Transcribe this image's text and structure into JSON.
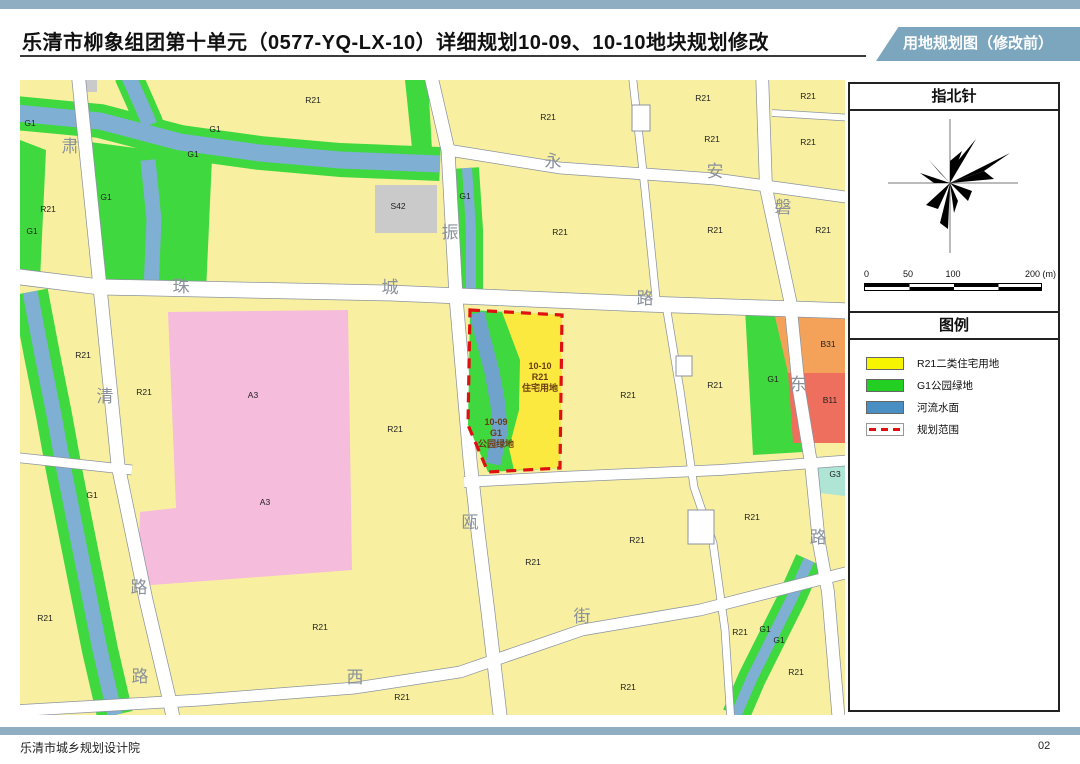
{
  "header": {
    "title": "乐清市柳象组团第十单元（0577-YQ-LX-10）详细规划10-09、10-10地块规划修改",
    "tag": "用地规划图（修改前）"
  },
  "footer": {
    "org": "乐清市城乡规划设计院",
    "page": "02"
  },
  "sidebar": {
    "compass_title": "指北针",
    "legend_title": "图例",
    "scale_ticks": [
      "0",
      "50",
      "100",
      "200 (m)"
    ],
    "legend_items": [
      {
        "label": "R21二类住宅用地",
        "swatch": "fill",
        "color": "#F7F400"
      },
      {
        "label": "G1公园绿地",
        "swatch": "fill",
        "color": "#22CF22"
      },
      {
        "label": "河流水面",
        "swatch": "fill",
        "color": "#4A8FC4"
      },
      {
        "label": "规划范围",
        "swatch": "dashed",
        "color": "#E01010"
      }
    ]
  },
  "map": {
    "colors": {
      "residential_yellow": "#F8F0A0",
      "park_green": "#3FD83F",
      "river_blue": "#7FAFD3",
      "plot_highlight_yellow": "#FBE93F",
      "a3_pink": "#F5BCDC",
      "s42_gray": "#CACACA",
      "b31_orange": "#F4A259",
      "b11_red": "#EF6F5E",
      "g3_mint": "#AEE5D4",
      "boundary_red": "#E01010",
      "road_white": "#FFFFFF"
    },
    "road_labels": [
      {
        "text": "肃",
        "x": 50,
        "y": 72
      },
      {
        "text": "清",
        "x": 85,
        "y": 322
      },
      {
        "text": "路",
        "x": 119,
        "y": 513
      },
      {
        "text": "珠",
        "x": 161,
        "y": 212
      },
      {
        "text": "城",
        "x": 370,
        "y": 213
      },
      {
        "text": "路",
        "x": 625,
        "y": 224
      },
      {
        "text": "振",
        "x": 430,
        "y": 158
      },
      {
        "text": "永",
        "x": 533,
        "y": 87
      },
      {
        "text": "安",
        "x": 695,
        "y": 97
      },
      {
        "text": "磐",
        "x": 763,
        "y": 133
      },
      {
        "text": "东",
        "x": 778,
        "y": 310
      },
      {
        "text": "路",
        "x": 798,
        "y": 463
      },
      {
        "text": "瓯",
        "x": 450,
        "y": 448
      },
      {
        "text": "街",
        "x": 562,
        "y": 542
      },
      {
        "text": "西",
        "x": 335,
        "y": 603
      },
      {
        "text": "路",
        "x": 120,
        "y": 602
      }
    ],
    "block_labels": [
      {
        "text": "R21",
        "x": 293,
        "y": 23
      },
      {
        "text": "R21",
        "x": 528,
        "y": 40
      },
      {
        "text": "R21",
        "x": 540,
        "y": 155
      },
      {
        "text": "R21",
        "x": 28,
        "y": 132
      },
      {
        "text": "R21",
        "x": 63,
        "y": 278
      },
      {
        "text": "R21",
        "x": 124,
        "y": 315
      },
      {
        "text": "R21",
        "x": 375,
        "y": 352
      },
      {
        "text": "R21",
        "x": 683,
        "y": 21
      },
      {
        "text": "R21",
        "x": 788,
        "y": 19
      },
      {
        "text": "R21",
        "x": 692,
        "y": 62
      },
      {
        "text": "R21",
        "x": 788,
        "y": 65
      },
      {
        "text": "R21",
        "x": 695,
        "y": 153
      },
      {
        "text": "R21",
        "x": 803,
        "y": 153
      },
      {
        "text": "R21",
        "x": 608,
        "y": 318
      },
      {
        "text": "R21",
        "x": 695,
        "y": 308
      },
      {
        "text": "R21",
        "x": 513,
        "y": 485
      },
      {
        "text": "R21",
        "x": 617,
        "y": 463
      },
      {
        "text": "R21",
        "x": 608,
        "y": 610
      },
      {
        "text": "R21",
        "x": 720,
        "y": 555
      },
      {
        "text": "R21",
        "x": 776,
        "y": 595
      },
      {
        "text": "R21",
        "x": 732,
        "y": 440
      },
      {
        "text": "R21",
        "x": 25,
        "y": 541
      },
      {
        "text": "R21",
        "x": 300,
        "y": 550
      },
      {
        "text": "R21",
        "x": 382,
        "y": 620
      },
      {
        "text": "G1",
        "x": 10,
        "y": 46
      },
      {
        "text": "G1",
        "x": 12,
        "y": 154
      },
      {
        "text": "G1",
        "x": 195,
        "y": 52
      },
      {
        "text": "G1",
        "x": 173,
        "y": 77
      },
      {
        "text": "G1",
        "x": 86,
        "y": 120
      },
      {
        "text": "G1",
        "x": 445,
        "y": 119
      },
      {
        "text": "G1",
        "x": 72,
        "y": 418
      },
      {
        "text": "G1",
        "x": 753,
        "y": 302
      },
      {
        "text": "G1",
        "x": 745,
        "y": 552
      },
      {
        "text": "G1",
        "x": 759,
        "y": 563
      },
      {
        "text": "A3",
        "x": 233,
        "y": 318
      },
      {
        "text": "A3",
        "x": 245,
        "y": 425
      },
      {
        "text": "S42",
        "x": 378,
        "y": 129
      },
      {
        "text": "B31",
        "x": 808,
        "y": 267
      },
      {
        "text": "B11",
        "x": 810,
        "y": 323
      },
      {
        "text": "G3",
        "x": 815,
        "y": 397
      }
    ],
    "plot_labels": [
      {
        "lines": [
          "10-10",
          "R21",
          "住宅用地"
        ],
        "x": 520,
        "y": 289,
        "line_h": 11
      },
      {
        "lines": [
          "10-09",
          "G1",
          "公园绿地"
        ],
        "x": 476,
        "y": 345,
        "line_h": 11
      }
    ]
  }
}
